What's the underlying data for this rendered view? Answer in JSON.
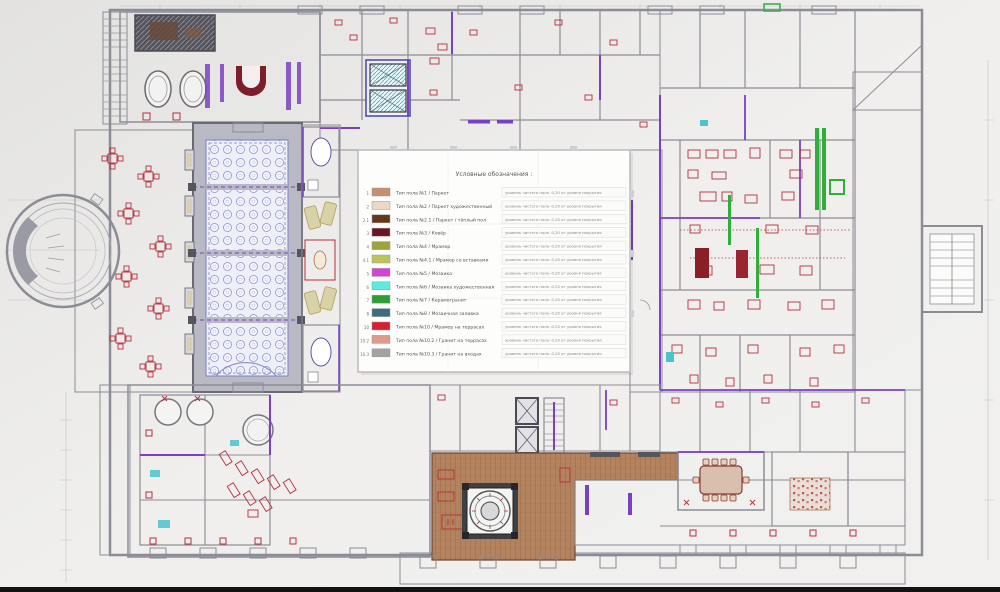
{
  "legend": {
    "title": "Условные обозначения :",
    "rows": [
      {
        "num": "1",
        "color": "#c4906e",
        "label": "Тип пола №1 / Паркет",
        "note": "уровень чистого пола -0,20 от уровня покрытия"
      },
      {
        "num": "2",
        "color": "#ead9c6",
        "label": "Тип пола №2 / Паркет художественный",
        "note": "уровень чистого пола -0,20 от уровня покрытия"
      },
      {
        "num": "2.1",
        "color": "#63381b",
        "label": "Тип пола №2.1 / Паркет / тёплый пол",
        "note": "уровень чистого пола -0,20 от уровня покрытия"
      },
      {
        "num": "3",
        "color": "#6b1528",
        "label": "Тип пола №3 / Ковёр",
        "note": "уровень чистого пола -0,20 от уровня покрытия"
      },
      {
        "num": "4",
        "color": "#9fa23e",
        "label": "Тип пола №4 / Мрамор",
        "note": "уровень чистого пола -0,20 от уровня покрытия"
      },
      {
        "num": "4.1",
        "color": "#bcc457",
        "label": "Тип пола №4.1 / Мрамор со вставками",
        "note": "уровень чистого пола -0,20 от уровня покрытия"
      },
      {
        "num": "5",
        "color": "#d443d4",
        "label": "Тип пола №5 / Мозаика",
        "note": "уровень чистого пола -0,20 от уровня покрытия"
      },
      {
        "num": "6",
        "color": "#5fe9df",
        "label": "Тип пола №6 / Мозаика художественная",
        "note": "уровень чистого пола -0,20 от уровня покрытия"
      },
      {
        "num": "7",
        "color": "#2e9e35",
        "label": "Тип пола №7 / Керамогранит",
        "note": "уровень чистого пола -0,20 от уровня покрытия"
      },
      {
        "num": "8",
        "color": "#3c6e7f",
        "label": "Тип пола №8 / Мозаичная заливка",
        "note": "уровень чистого пола -0,20 от уровня покрытия"
      },
      {
        "num": "10",
        "color": "#d6222f",
        "label": "Тип пола №10 / Мрамор на террасах",
        "note": "уровень чистого пола -0,20 от уровня покрытия"
      },
      {
        "num": "10.2",
        "color": "#df9a88",
        "label": "Тип пола №10.2 / Гранит на террасах",
        "note": "уровень чистого пола -0,20 от уровня покрытия"
      },
      {
        "num": "10.3",
        "color": "#a3a3a3",
        "label": "Тип пола №10.3 / Гранит на входах",
        "note": "уровень чистого пола -0,20 от уровня покрытия"
      }
    ]
  },
  "colors": {
    "background": "#e9e8e6",
    "paper": "#f8f8f6",
    "wall": "#8c8c96",
    "wall_dark": "#4a4a52",
    "purple": "#7b3fc4",
    "red": "#b3303c",
    "dark_red": "#7c1f2a",
    "green": "#2fae3a",
    "cyan": "#49c4cc",
    "brown_floor": "#b3825e",
    "tan": "#c4906e",
    "letterbox": "#121212"
  }
}
